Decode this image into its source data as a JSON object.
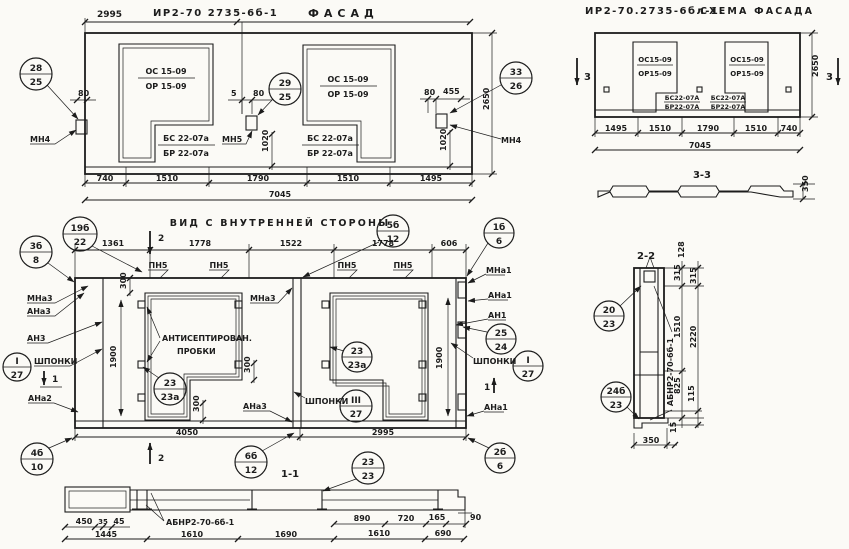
{
  "colors": {
    "ink": "#1c1c1c",
    "paper": "#fbfaf6"
  },
  "facade": {
    "dim_top": "2995",
    "mark": "ИР2-70 2735-6б-1",
    "title": "ФАСАД",
    "win1_line1": "ОС 15-09",
    "win1_line2": "ОР 15-09",
    "win2_line1": "ОС 15-09",
    "win2_line2": "ОР 15-09",
    "sill1_line1": "БС 22-07а",
    "sill1_line2": "БР 22-07а",
    "sill2_line1": "БС 22-07а",
    "sill2_line2": "БР 22-07а",
    "anchor_left": "МН4",
    "anchor_mid": "МН5",
    "anchor_right": "МН4",
    "co_left": {
      "t": "28",
      "b": "25"
    },
    "co_mid": {
      "t": "29",
      "b": "25"
    },
    "co_right": {
      "t": "33",
      "b": "26"
    },
    "d80l": "80",
    "d5": "5",
    "d80m": "80",
    "d80r": "80",
    "d455": "455",
    "d1020m": "1020",
    "d1020r": "1020",
    "d2650": "2650",
    "dims_bottom": [
      "740",
      "1510",
      "1790",
      "1510",
      "1495"
    ],
    "dim_total": "7045"
  },
  "schema": {
    "mark": "ИР2-70.2735-6бл-1.",
    "title": "СХЕМА ФАСАДА",
    "win1_line1": "ОС15-09",
    "win1_line2": "ОР15-09",
    "win2_line1": "ОС15-09",
    "win2_line2": "ОР15-09",
    "sill1_line1": "БС22-07А",
    "sill1_line2": "БР22-07А",
    "sill2_line1": "БС22-07А",
    "sill2_line2": "БР22-07А",
    "dims_bottom": [
      "1495",
      "1510",
      "1790",
      "1510",
      "740"
    ],
    "dim_total": "7045",
    "dim_height": "2650",
    "sec_mark": "3",
    "sec_title": "3-3",
    "d350": "350"
  },
  "inner": {
    "title": "ВИД С ВНУТРЕННЕЙ СТОРОНЫ",
    "dims_top": [
      "1361",
      "1778",
      "1522",
      "1778",
      "606"
    ],
    "pn1": "ПН5",
    "pn2": "ПН5",
    "pn3": "ПН5",
    "pn4": "ПН5",
    "co_19b": {
      "t": "19б",
      "b": "22"
    },
    "co_3b": {
      "t": "3б",
      "b": "8"
    },
    "co_5b": {
      "t": "5б",
      "b": "12"
    },
    "co_1b": {
      "t": "1б",
      "b": "6"
    },
    "co_25": {
      "t": "25",
      "b": "24"
    },
    "co_key_l": {
      "t": "I",
      "b": "27"
    },
    "co_key_r": {
      "t": "I",
      "b": "27"
    },
    "co_key_m": {
      "t": "III",
      "b": "27"
    },
    "co_23a_1": {
      "t": "23",
      "b": "23а"
    },
    "co_23a_2": {
      "t": "23",
      "b": "23а"
    },
    "co_4b": {
      "t": "4б",
      "b": "10"
    },
    "co_6b": {
      "t": "6б",
      "b": "12"
    },
    "co_23": {
      "t": "23",
      "b": "23"
    },
    "co_2b": {
      "t": "2б",
      "b": "6"
    },
    "lbl_mna3_l": "МНа3",
    "lbl_ana3_l": "АНа3",
    "lbl_an3": "АН3",
    "lbl_shponki_l": "ШПОНКИ",
    "lbl_ana2": "АНа2",
    "lbl_mna3_m": "МНа3",
    "lbl_ana3_m": "АНа3",
    "lbl_mna1": "МНа1",
    "lbl_ana1_t": "АНа1",
    "lbl_an1": "АН1",
    "lbl_shponki_r": "ШПОНКИ",
    "lbl_shponki_m": "ШПОНКИ",
    "lbl_ana1_b": "АНа1",
    "note_line1": "АНТИСЕПТИРОВАН.",
    "note_line2": "ПРОБКИ",
    "d300a": "300",
    "d300b": "300",
    "d300c": "300",
    "d1900l": "1900",
    "d1900r": "1900",
    "dim_4050": "4050",
    "dim_2995": "2995",
    "sec1": "1",
    "sec2": "2"
  },
  "sec11": {
    "title": "1-1",
    "mark": "АБНР2-70-6б-1",
    "d450": "450",
    "d35": "35",
    "d45": "45",
    "dims_row2": [
      "1445",
      "1610",
      "1690",
      "1610",
      "690"
    ],
    "d890": "890",
    "d720": "720",
    "d165": "165",
    "d90": "90"
  },
  "sec22": {
    "title": "2-2",
    "mark": "АБНР2-70-6б-1",
    "co_20": {
      "t": "20",
      "b": "23"
    },
    "co_24b": {
      "t": "24б",
      "b": "23"
    },
    "d128": "128",
    "d315a": "315",
    "d315b": "315",
    "d1510": "1510",
    "d2220": "2220",
    "d825": "825",
    "d115": "115",
    "d350": "350",
    "d15": "15"
  }
}
